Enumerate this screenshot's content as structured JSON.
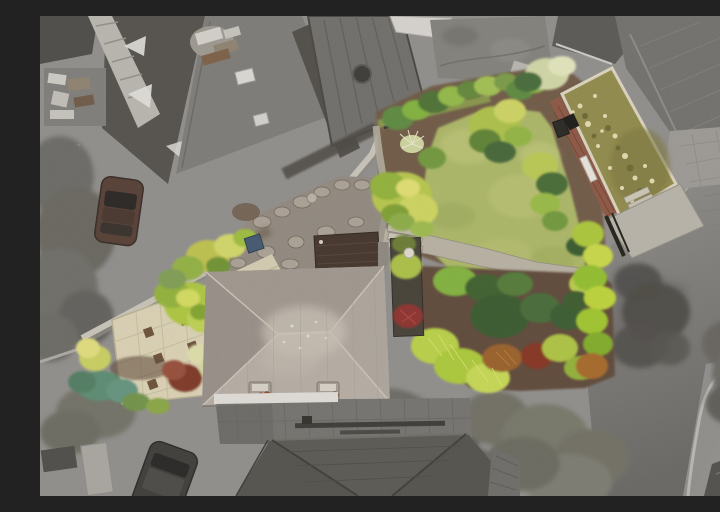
{
  "image": {
    "type": "aerial-drone-photograph",
    "subject": "Top-down aerial photo of a detached house and its triangular garden plot shown in colour, with all neighbouring roofs, driveways, trees and roads desaturated to grayscale",
    "width_px": 720,
    "height_px": 480
  },
  "palette": {
    "bg": "#8d8b88",
    "roofDark": "#55524d",
    "roofMid": "#7b7975",
    "roofLight": "#b5b1ab",
    "houseRoof": "#a59d94",
    "houseRoofLight": "#c4bcb0",
    "frontRoof": "#55534e",
    "road": "#767472",
    "wall": "#c4bfb4",
    "pavingCream": "#d6cdb0",
    "pavingSquare": "#6b523c",
    "crazyPaving": "#8e867c",
    "path": "#b4ad9e",
    "lawn": "#a8b366",
    "lawnLight": "#bcc276",
    "soil": "#6d5945",
    "bushDark": "#3e5a32",
    "bushGreen": "#7fae3f",
    "bushLime": "#b5cc4a",
    "bushYellow": "#c5ca60",
    "bushTeal": "#5c8870",
    "bushMaroon": "#7b3a2c",
    "bushOrange": "#96602e",
    "bushWhite": "#d9d9a6",
    "mossRoof": "#8d874d",
    "mossLight": "#ded5ac",
    "brick": "#8a5746",
    "treeGray": "#6b6a64",
    "treeOlive": "#757468",
    "carGray": "#41403d",
    "carMaroon": "#564138",
    "fenceDark": "#3c3b37",
    "concrete": "#b3afa5",
    "white": "#dbd8d3",
    "extRoof": "#46382f"
  },
  "scene": {
    "highlighted_property": [
      "hipped-roof house",
      "rear lawn",
      "garden path",
      "shrub borders",
      "brick outbuilding with mossy flat roof",
      "cream paved patio with dark accent slabs",
      "crazy-paving patio",
      "stone boundary wall"
    ],
    "grayscale_surroundings": [
      "neighbour roofs top-left",
      "neighbour decking and garden top-centre",
      "neighbour house top-right",
      "road along right edge curving at bottom",
      "large overhanging trees bottom-centre",
      "driveways with two parked cars"
    ]
  }
}
